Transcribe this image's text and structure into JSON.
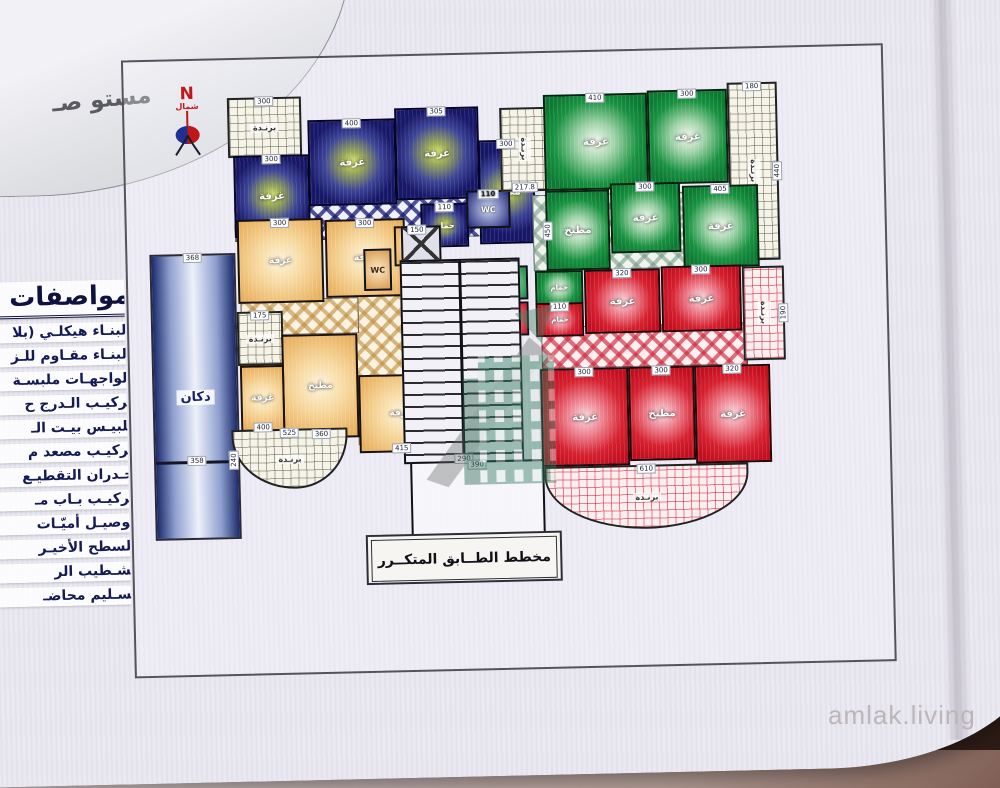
{
  "photo": {
    "watermark": "amlak.living"
  },
  "banner": {
    "corner_calligraphy": "مستو صـ",
    "plan_title": "مخطط الطــابق المتكــرر"
  },
  "north": {
    "letter": "N",
    "label": "شمال"
  },
  "specs": {
    "title": "مواصفات ا",
    "lines": [
      "البنـاء هيكلـي (بلا",
      "البنـاء مقـاوم للـز",
      "الواجهـات ملبسـة",
      "تركيـب الـدرج ح",
      "تلبيـس بيـت الـ",
      "تركيـب مصعد م",
      "جـدران التقطيـع",
      "تركيـب بـاب مـ",
      "توصيـل أميّـات",
      "السطح الأخيـر",
      "تشـطيب الر",
      "تسـليم محاضـ"
    ]
  },
  "shop": {
    "label": "دكان",
    "dim_top": "368",
    "dim_mid": "358"
  },
  "core": {
    "stair_dim": "290",
    "entry_dim_top": "390",
    "entry_dim_bottom": "390",
    "wc": "WC"
  },
  "apartments": {
    "blue": {
      "balcony": {
        "label": "برنـدة",
        "dim": "300"
      },
      "rooms": [
        {
          "label": "غرفة",
          "dim": "300"
        },
        {
          "label": "غرفة",
          "dim": "400"
        },
        {
          "label": "غرفة",
          "dim": "305"
        },
        {
          "label": "مطبخ",
          "dim": "300"
        },
        {
          "label": "حمام",
          "dim": "110"
        },
        {
          "label": "WC",
          "dim": "110"
        }
      ]
    },
    "green": {
      "balcony_side": {
        "label": "برنـدة",
        "dim_w": "180",
        "dim_h": "440"
      },
      "balcony_small": {
        "label": "برنـدة",
        "dim": "217.8"
      },
      "rooms": [
        {
          "label": "غرفة",
          "dim": "410"
        },
        {
          "label": "غرفة",
          "dim": "300"
        },
        {
          "label": "مطبخ",
          "dim": "450"
        },
        {
          "label": "غرفة",
          "dim": "300"
        },
        {
          "label": "غرفة",
          "dim": "405"
        },
        {
          "label": "حمام",
          "dim": "110"
        }
      ]
    },
    "orange": {
      "balcony_small": {
        "label": "برنـدة",
        "dim": "175"
      },
      "balcony_curved": {
        "label": "برنـدة",
        "dim_w": "525",
        "dim_h": "240"
      },
      "rooms": [
        {
          "label": "غرفة",
          "dim": "300"
        },
        {
          "label": "غرفة",
          "dim": "300"
        },
        {
          "label": "حمام",
          "dim": "150"
        },
        {
          "label": "WC",
          "dim": "100"
        },
        {
          "label": "مطبخ",
          "dim": "360"
        },
        {
          "label": "غرفة",
          "dim": "400"
        },
        {
          "label": "غرفة",
          "dim": "415"
        }
      ]
    },
    "red": {
      "balcony_side": {
        "label": "برنـدة",
        "dim": "190"
      },
      "balcony_curved": {
        "label": "برنـدة",
        "dim": "610"
      },
      "rooms": [
        {
          "label": "حمام",
          "dim": "110"
        },
        {
          "label": "غرفة",
          "dim": "320"
        },
        {
          "label": "غرفة",
          "dim": "300"
        },
        {
          "label": "غرفة",
          "dim": "300"
        },
        {
          "label": "مطبخ",
          "dim": "300"
        },
        {
          "label": "غرفة",
          "dim": "320"
        }
      ]
    }
  },
  "colors": {
    "blue_room": "#171768",
    "green_room": "#0b7a32",
    "orange_room": "#edba6e",
    "red_room": "#c20e1e",
    "banner": "#eae8f1",
    "backdrop_brown": "#2e1c16",
    "accent_red": "#c01818"
  }
}
